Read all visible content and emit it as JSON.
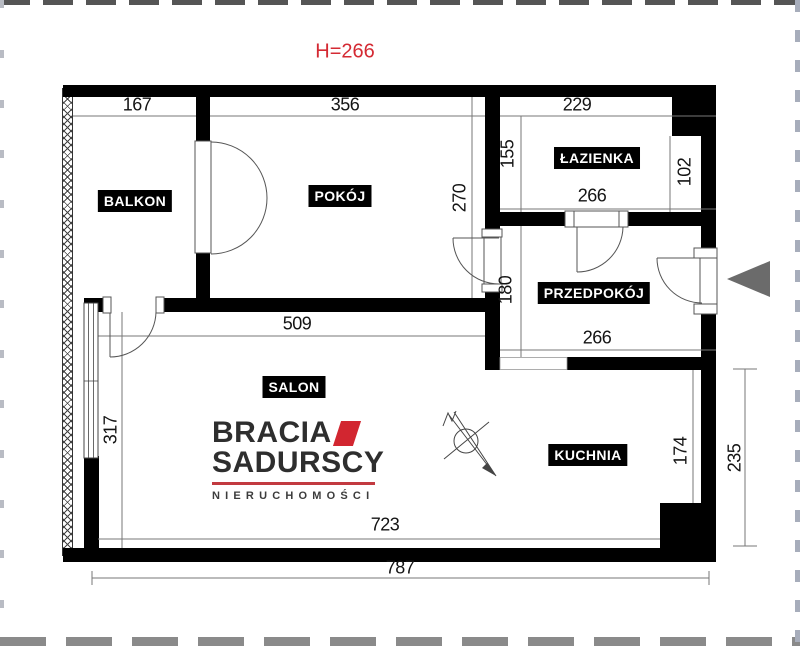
{
  "plan": {
    "ceiling_note": "H=266",
    "rooms": {
      "balkon": {
        "label": "BALKON"
      },
      "pokoj": {
        "label": "POKÓJ"
      },
      "lazienka": {
        "label": "ŁAZIENKA"
      },
      "przedpokoj": {
        "label": "PRZEDPOKÓJ"
      },
      "salon": {
        "label": "SALON"
      },
      "kuchnia": {
        "label": "KUCHNIA"
      }
    },
    "dimensions": {
      "balkon_width": "167",
      "pokoj_width": "356",
      "lazienka_width": "229",
      "lazienka_left_depth": "155",
      "lazienka_right_depth": "102",
      "lazienka_bottom_width": "266",
      "pokoj_depth": "270",
      "przedpokoj_depth": "180",
      "przedpokoj_bottom_width": "266",
      "salon_top_width": "509",
      "salon_left_depth": "317",
      "kuchnia_right_depth": "174",
      "kuchnia_outer_depth": "235",
      "salon_bottom_width": "723",
      "total_width": "787"
    },
    "colors": {
      "wall": "#000000",
      "accent_red": "#d42a33",
      "logo_red": "#d22630",
      "logo_text": "#2e2e2e",
      "arrow_gray": "#6b6b6b"
    },
    "icons": {
      "entrance_arrow": "entrance-arrow-icon",
      "ceiling_point": "crossed-circle-ceiling-symbol"
    }
  },
  "logo": {
    "line1": "BRACIA",
    "line2": "SADURSCY",
    "line3": "NIERUCHOMOŚCI"
  }
}
